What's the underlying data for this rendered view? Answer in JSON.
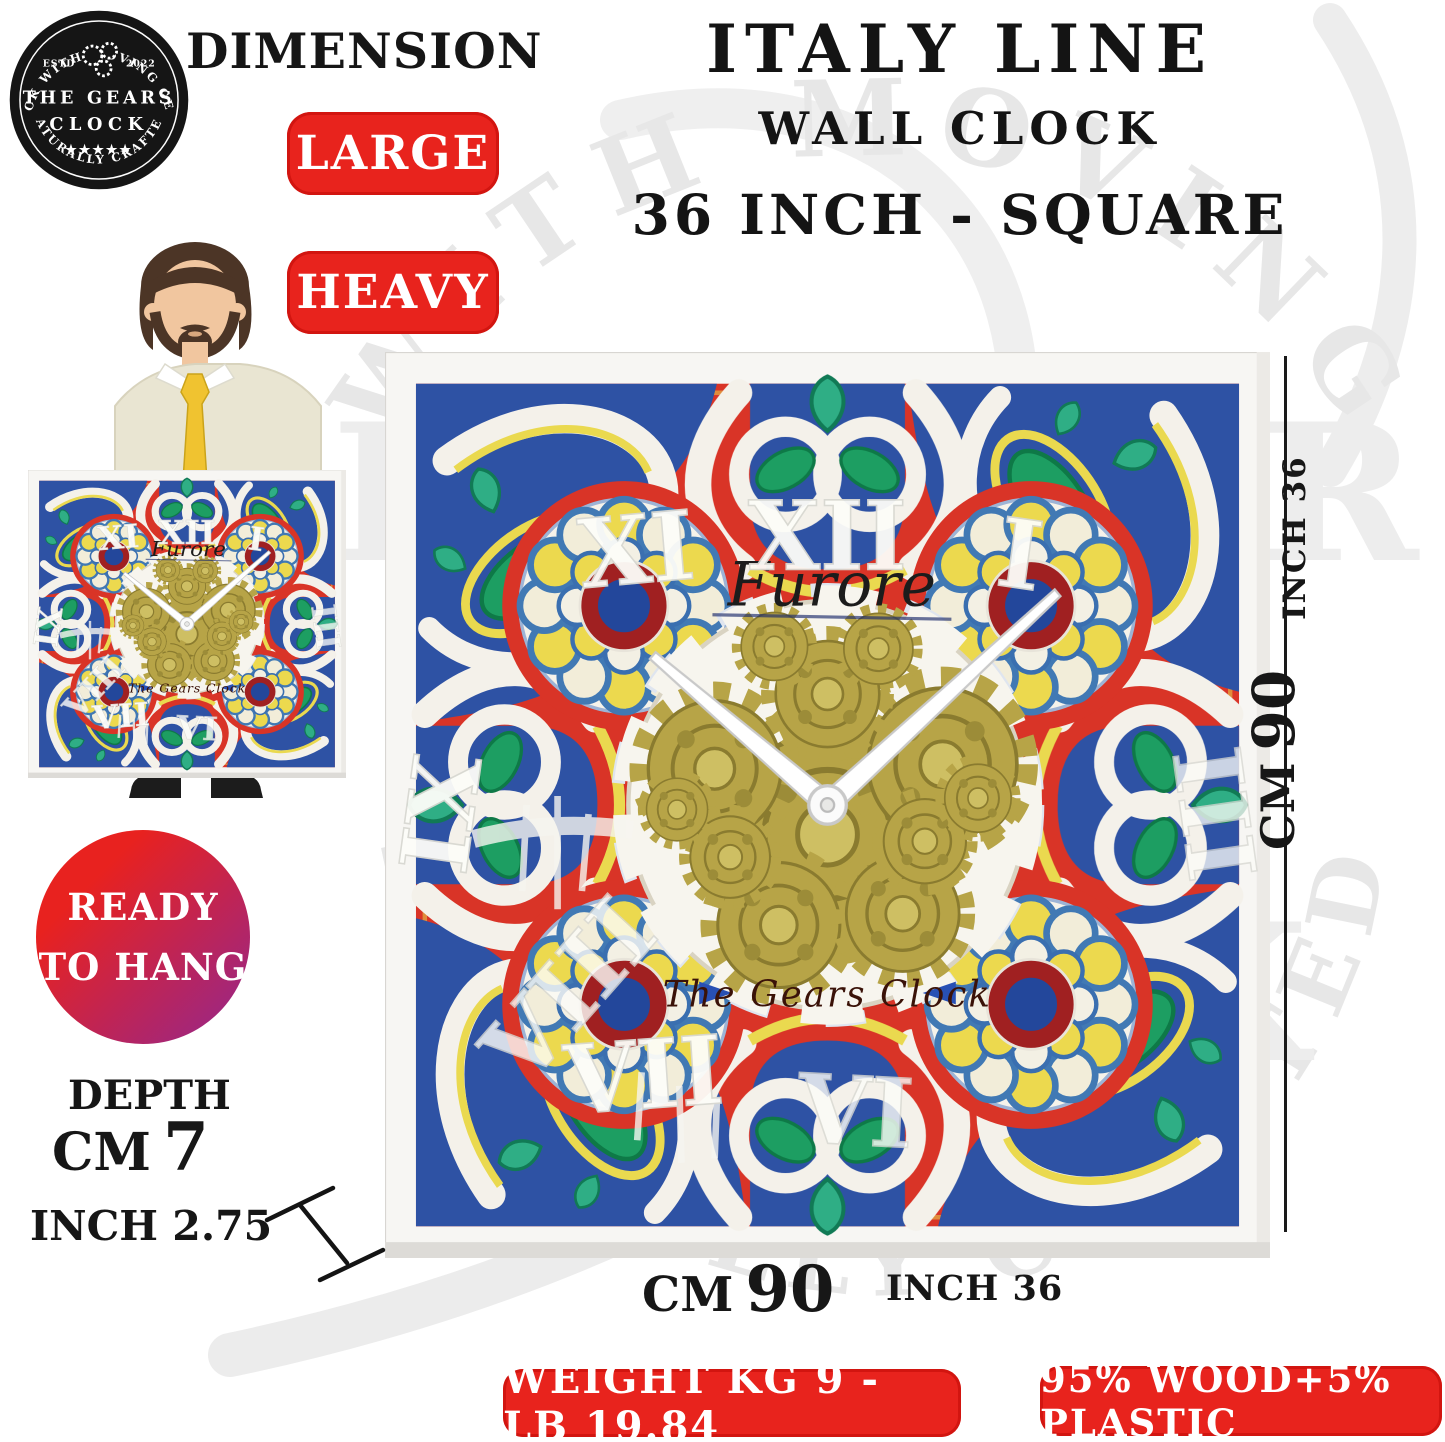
{
  "logo": {
    "arc_top": "CLOCK WITH MOVING GEARS",
    "estd": "ESTD",
    "year": "2022",
    "name_line1": "THE GEARS",
    "name_line2": "CLOCK",
    "stars": "★★★★★",
    "arc_bottom": "NATURALLY CRAFTED"
  },
  "header": {
    "dimension_label": "DIMENSION",
    "badge_large": "LARGE",
    "badge_heavy": "HEAVY",
    "title_line1": "ITALY LINE",
    "title_line2": "WALL CLOCK",
    "title_line3": "36 INCH - SQUARE"
  },
  "ready_badge": {
    "line1": "READY",
    "line2": "TO HANG"
  },
  "depth": {
    "label": "DEPTH",
    "cm_unit": "CM",
    "cm_value": "7",
    "inch_text": "INCH 2.75"
  },
  "clockface": {
    "brand_top": "Furore",
    "brand_bottom": "The Gears Clock",
    "numerals": {
      "n11": "XI",
      "n12": "XII",
      "n1": "I",
      "n9": "IX",
      "n3": "III",
      "n8": "VIII",
      "n7": "VII",
      "n6": "VI"
    }
  },
  "dimensions": {
    "right_inch": "INCH 36",
    "right_cm_unit": "CM",
    "right_cm_value": "90",
    "bottom_cm_unit": "CM",
    "bottom_cm_value": "90",
    "bottom_inch": "INCH 36"
  },
  "footer": {
    "weight_badge": "WEIGHT KG 9 - LB 19.84",
    "material_badge": "95% WOOD+5% PLASTIC"
  },
  "watermark": {
    "arc_top": "WITH MOVING",
    "center_line1": "THE GEARS",
    "center_line2": "CLOCK",
    "arc_bottom": "NATURALLY CRAFTED"
  },
  "colors": {
    "badge_red": "#e8231d",
    "clock_red": "#d93427",
    "clock_blue": "#2e52a4",
    "gear_gold": "#b7a447",
    "leaf_green": "#1d9e62",
    "accent_yellow": "#ead94f",
    "ready_gradient_from": "#e8221f",
    "ready_gradient_to": "#93278f"
  }
}
